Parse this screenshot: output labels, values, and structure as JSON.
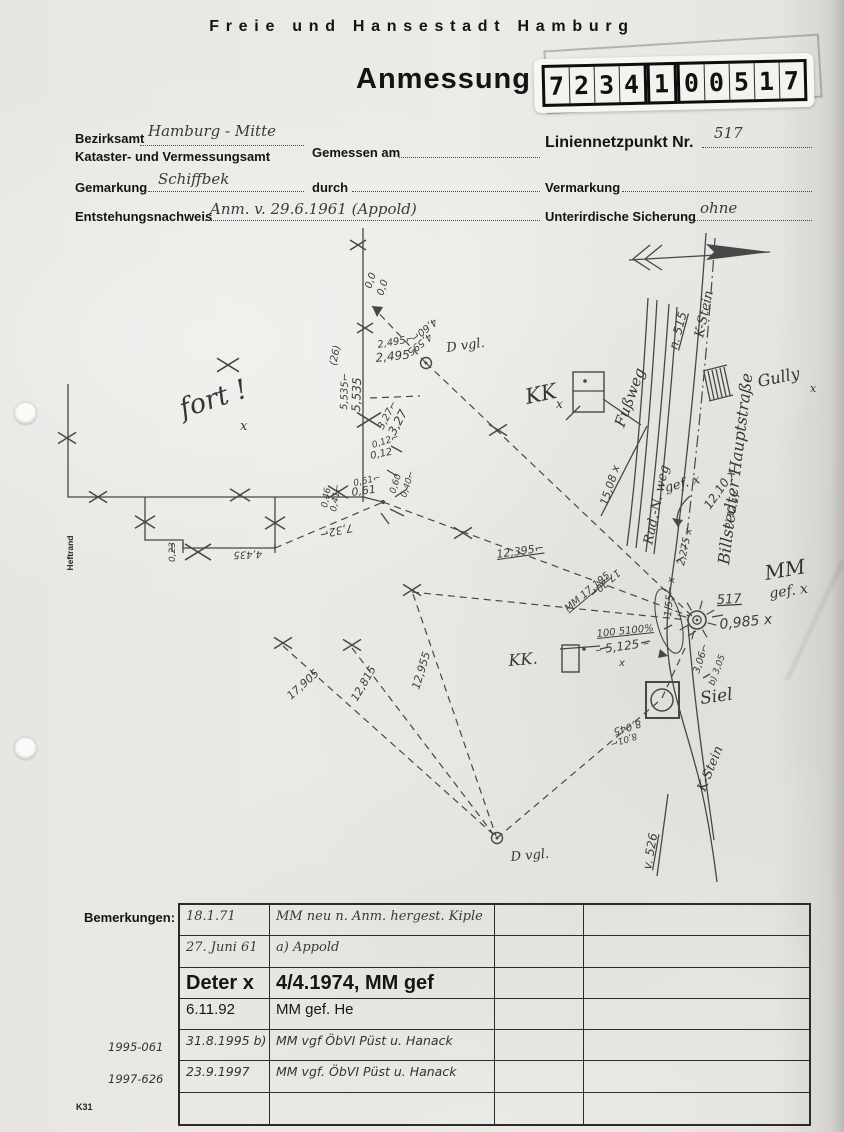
{
  "header": {
    "city_title": "Freie und Hansestadt Hamburg",
    "form_title": "Anmessung"
  },
  "number_label": {
    "groups": [
      [
        "7",
        "2",
        "3",
        "4"
      ],
      [
        "1"
      ],
      [
        "0",
        "0",
        "5",
        "1",
        "7"
      ]
    ]
  },
  "form": {
    "bezirksamt_label": "Bezirksamt",
    "bezirksamt_value": "Hamburg - Mitte",
    "amt_label": "Kataster- und Vermessungsamt",
    "gemessen_am_label": "Gemessen am",
    "gemarkung_label": "Gemarkung",
    "gemarkung_value": "Schiffbek",
    "durch_label": "durch",
    "entstehung_label": "Entstehungsnachweis",
    "entstehung_value": "Anm. v. 29.6.1961 (Appold)",
    "liniennetzpunkt_label": "Liniennetzpunkt Nr.",
    "liniennetzpunkt_value": "517",
    "vermarkung_label": "Vermarkung",
    "sicherung_label": "Unterirdische Sicherung",
    "sicherung_value": "ohne"
  },
  "sketch": {
    "labels": [
      {
        "t": "0,0",
        "x": 371,
        "y": 289,
        "r": -72,
        "s": 10,
        "c": "pm"
      },
      {
        "t": "0,0",
        "x": 383,
        "y": 296,
        "r": -72,
        "s": 10,
        "c": "pm"
      },
      {
        "t": "(26)",
        "x": 336,
        "y": 366,
        "r": -78,
        "s": 10,
        "c": "pm"
      },
      {
        "t": "2,495⌐",
        "x": 378,
        "y": 348,
        "r": -10,
        "s": 10,
        "c": "pm"
      },
      {
        "t": "2,495",
        "x": 376,
        "y": 362,
        "r": -6,
        "s": 12,
        "c": "pm"
      },
      {
        "t": "4,60⌐",
        "x": 434,
        "y": 318,
        "r": 142,
        "s": 10,
        "c": "pm"
      },
      {
        "t": "4,595",
        "x": 429,
        "y": 333,
        "r": 142,
        "s": 10,
        "c": "pm"
      },
      {
        "t": "D vgl.",
        "x": 447,
        "y": 352,
        "r": -8,
        "s": 13,
        "c": "hs"
      },
      {
        "t": "5,535⌐",
        "x": 347,
        "y": 410,
        "r": -88,
        "s": 10,
        "c": "pm"
      },
      {
        "t": "5,535",
        "x": 360,
        "y": 412,
        "r": -88,
        "s": 12,
        "c": "pm"
      },
      {
        "t": "3,27⌐",
        "x": 383,
        "y": 430,
        "r": -62,
        "s": 10,
        "c": "pm"
      },
      {
        "t": "3,27",
        "x": 395,
        "y": 436,
        "r": -62,
        "s": 12,
        "c": "pm"
      },
      {
        "t": "0,12⌐",
        "x": 373,
        "y": 448,
        "r": -18,
        "s": 9,
        "c": "pm"
      },
      {
        "t": "0,12",
        "x": 371,
        "y": 459,
        "r": -12,
        "s": 10,
        "c": "pm"
      },
      {
        "t": "0,61⌐",
        "x": 354,
        "y": 486,
        "r": -12,
        "s": 9,
        "c": "pm"
      },
      {
        "t": "0,61",
        "x": 352,
        "y": 496,
        "r": -8,
        "s": 11,
        "c": "pm"
      },
      {
        "t": "0,60",
        "x": 395,
        "y": 494,
        "r": -72,
        "s": 9,
        "c": "pm"
      },
      {
        "t": "0,40⌐",
        "x": 406,
        "y": 498,
        "r": -72,
        "s": 9,
        "c": "pm"
      },
      {
        "t": "0,46",
        "x": 327,
        "y": 508,
        "r": -80,
        "s": 9,
        "c": "pm"
      },
      {
        "t": "0,41⌐",
        "x": 336,
        "y": 512,
        "r": -80,
        "s": 9,
        "c": "pm"
      },
      {
        "t": "7,32⌐",
        "x": 352,
        "y": 524,
        "r": 168,
        "s": 11,
        "c": "pm"
      },
      {
        "t": "4,435",
        "x": 262,
        "y": 551,
        "r": 178,
        "s": 10,
        "c": "pm"
      },
      {
        "t": "0,23",
        "x": 175,
        "y": 562,
        "r": -90,
        "s": 9,
        "c": "pm"
      },
      {
        "t": "fort !",
        "x": 183,
        "y": 418,
        "r": -18,
        "s": 27,
        "c": "hs"
      },
      {
        "t": "x",
        "x": 240,
        "y": 430,
        "r": 0,
        "s": 13,
        "c": "hs"
      },
      {
        "t": "KK",
        "x": 527,
        "y": 404,
        "r": -12,
        "s": 21,
        "c": "hs"
      },
      {
        "t": "x",
        "x": 556,
        "y": 408,
        "r": 0,
        "s": 12,
        "c": "hs"
      },
      {
        "t": "KK.",
        "x": 509,
        "y": 666,
        "r": -5,
        "s": 16,
        "c": "hs"
      },
      {
        "t": "Fußweg",
        "x": 624,
        "y": 428,
        "r": -70,
        "s": 15,
        "c": "hs"
      },
      {
        "t": "Rad.-N. weg",
        "x": 652,
        "y": 545,
        "r": -78,
        "s": 13,
        "c": "hs"
      },
      {
        "t": "gef. x",
        "x": 666,
        "y": 492,
        "r": -15,
        "s": 13,
        "c": "hs"
      },
      {
        "t": "n. 515",
        "x": 677,
        "y": 350,
        "r": -75,
        "s": 12,
        "c": "pm",
        "u": 1
      },
      {
        "t": "K-Stein",
        "x": 703,
        "y": 338,
        "r": -78,
        "s": 13,
        "c": "hs"
      },
      {
        "t": "Billstedter Hauptstraße",
        "x": 729,
        "y": 565,
        "r": -83,
        "s": 16,
        "c": "hs"
      },
      {
        "t": "Gully",
        "x": 759,
        "y": 387,
        "r": -12,
        "s": 16,
        "c": "hs"
      },
      {
        "t": "x",
        "x": 810,
        "y": 392,
        "r": 0,
        "s": 11,
        "c": "hs"
      },
      {
        "t": "15,08 x",
        "x": 607,
        "y": 506,
        "r": -72,
        "s": 11,
        "c": "pm"
      },
      {
        "t": "12,10 x",
        "x": 710,
        "y": 510,
        "r": -55,
        "s": 12,
        "c": "pm"
      },
      {
        "t": "b) 12,17",
        "x": 729,
        "y": 529,
        "r": -72,
        "s": 9,
        "c": "pm"
      },
      {
        "t": "12,395⌐",
        "x": 497,
        "y": 558,
        "r": -8,
        "s": 11,
        "c": "pm",
        "u": 1
      },
      {
        "t": "17,20⌐",
        "x": 617,
        "y": 569,
        "r": 140,
        "s": 10,
        "c": "pm"
      },
      {
        "t": "MM 17,195",
        "x": 568,
        "y": 612,
        "r": -40,
        "s": 10,
        "c": "pm",
        "u": 1
      },
      {
        "t": "100 5100%",
        "x": 597,
        "y": 637,
        "r": -6,
        "s": 10,
        "c": "pm",
        "u": 1
      },
      {
        "t": "– 5,125 –",
        "x": 596,
        "y": 654,
        "r": -8,
        "s": 12,
        "c": "pm"
      },
      {
        "t": "x",
        "x": 619,
        "y": 666,
        "r": 0,
        "s": 10,
        "c": "pm"
      },
      {
        "t": "1,55⌐ x",
        "x": 671,
        "y": 617,
        "r": -85,
        "s": 10,
        "c": "pm"
      },
      {
        "t": "2,275 x",
        "x": 684,
        "y": 566,
        "r": -78,
        "s": 10,
        "c": "pm"
      },
      {
        "t": "517",
        "x": 717,
        "y": 604,
        "r": -3,
        "s": 13,
        "c": "pm",
        "u": 1
      },
      {
        "t": "0,985 x",
        "x": 720,
        "y": 629,
        "r": -6,
        "s": 14,
        "c": "pm"
      },
      {
        "t": "MM",
        "x": 766,
        "y": 580,
        "r": -10,
        "s": 20,
        "c": "hs"
      },
      {
        "t": "gef. x",
        "x": 770,
        "y": 598,
        "r": -8,
        "s": 14,
        "c": "hs"
      },
      {
        "t": "3,06⌐",
        "x": 699,
        "y": 674,
        "r": -72,
        "s": 10,
        "c": "pm"
      },
      {
        "t": "b) 3,05",
        "x": 714,
        "y": 686,
        "r": -70,
        "s": 9,
        "c": "pm"
      },
      {
        "t": "Siel",
        "x": 701,
        "y": 704,
        "r": -8,
        "s": 17,
        "c": "hs"
      },
      {
        "t": "8,045",
        "x": 640,
        "y": 720,
        "r": 162,
        "s": 10,
        "c": "pm"
      },
      {
        "t": "8,01⌐",
        "x": 636,
        "y": 733,
        "r": 162,
        "s": 9,
        "c": "pm"
      },
      {
        "t": "K-Stein",
        "x": 705,
        "y": 792,
        "r": -68,
        "s": 13,
        "c": "hs"
      },
      {
        "t": "v. 526",
        "x": 651,
        "y": 870,
        "r": -80,
        "s": 12,
        "c": "pm",
        "u": 1
      },
      {
        "t": "D vgl.",
        "x": 511,
        "y": 861,
        "r": -5,
        "s": 13,
        "c": "hs"
      },
      {
        "t": "17,905",
        "x": 291,
        "y": 700,
        "r": -42,
        "s": 11,
        "c": "pm"
      },
      {
        "t": "12,815",
        "x": 357,
        "y": 702,
        "r": -60,
        "s": 11,
        "c": "pm"
      },
      {
        "t": "12,955",
        "x": 419,
        "y": 690,
        "r": -73,
        "s": 11,
        "c": "pm"
      }
    ]
  },
  "margin": {
    "heftrand": "Heftrand",
    "k31": "K31"
  },
  "remarks": {
    "label": "Bemerkungen:",
    "rows": [
      {
        "date": "18.1.71",
        "text": "MM neu n. Anm. hergest. Kiple",
        "style": "rw"
      },
      {
        "date": "27. Juni 61",
        "text": "a) Appold",
        "style": "rw"
      },
      {
        "date": "Deter x",
        "text": "4/4.1974, MM gef",
        "style": "rw-big"
      },
      {
        "date": "6.11.92",
        "text": "MM gef. He",
        "style": "rw-med"
      },
      {
        "date": "31.8.1995 b)",
        "text": "MM vgf ÖbVI Püst u. Hanack",
        "style": "rw-print"
      },
      {
        "date": "23.9.1997",
        "text": "MM vgf. ÖbVI Püst u. Hanack",
        "style": "rw-print"
      },
      {
        "date": "",
        "text": "",
        "style": "rw"
      }
    ],
    "margin_notes": [
      "1995-061",
      "1997-626"
    ]
  }
}
